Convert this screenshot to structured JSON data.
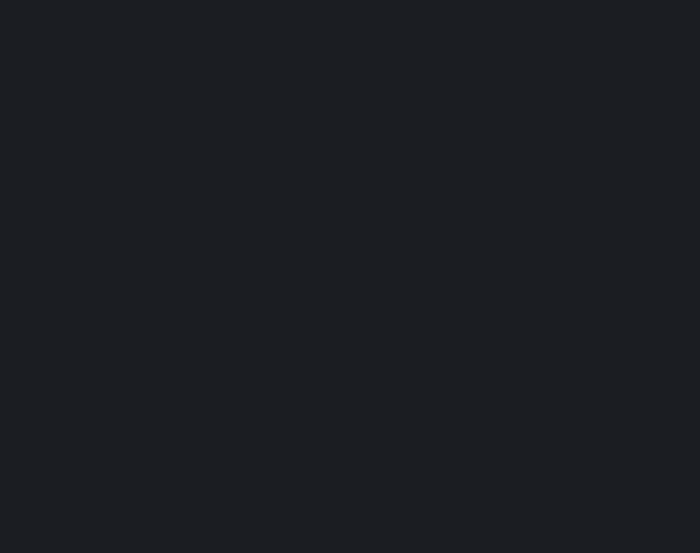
{
  "screen": {
    "background_color": "#1b1d22",
    "content": ""
  }
}
